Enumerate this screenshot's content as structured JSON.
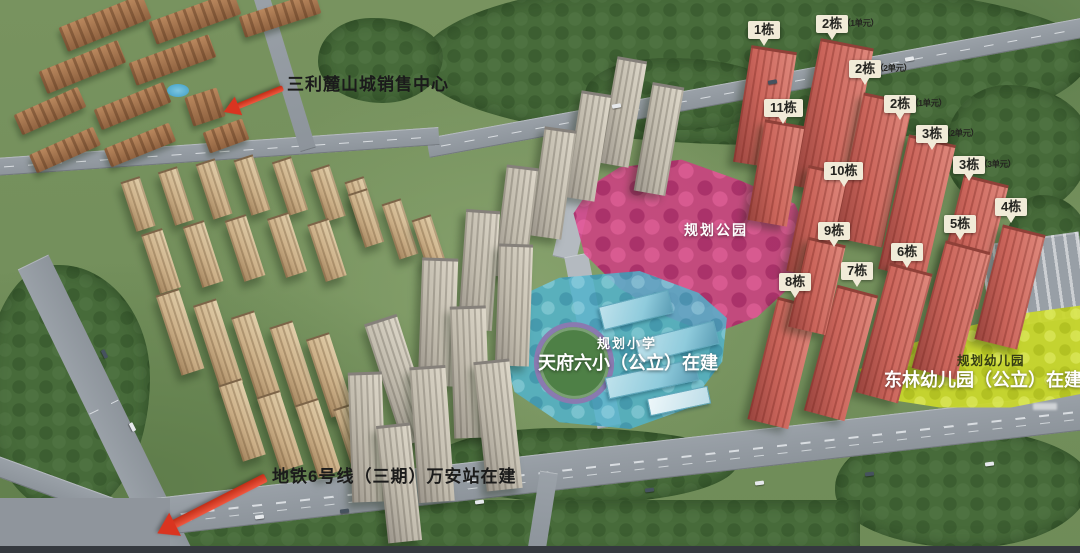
{
  "map": {
    "annotations": {
      "sales_center": "三利麓山城销售中心",
      "metro_line": "地铁6号线（三期）万安站在建",
      "park": "规划公园",
      "school_tag": "规划小学",
      "school_name": "天府六小（公立）在建",
      "kindergarten_tag": "规划幼儿园",
      "kindergarten_name": "东林幼儿园（公立）在建"
    },
    "building_labels": [
      {
        "main": "1栋",
        "sub": "",
        "x": 748,
        "y": 21
      },
      {
        "main": "2栋",
        "sub": "（1单元）",
        "x": 816,
        "y": 15
      },
      {
        "main": "2栋",
        "sub": "（2单元）",
        "x": 849,
        "y": 60
      },
      {
        "main": "2栋",
        "sub": "（1单元）",
        "x": 884,
        "y": 95
      },
      {
        "main": "3栋",
        "sub": "（2单元）",
        "x": 916,
        "y": 125
      },
      {
        "main": "3栋",
        "sub": "（3单元）",
        "x": 953,
        "y": 156
      },
      {
        "main": "4栋",
        "sub": "",
        "x": 995,
        "y": 198
      },
      {
        "main": "5栋",
        "sub": "",
        "x": 944,
        "y": 215
      },
      {
        "main": "6栋",
        "sub": "",
        "x": 891,
        "y": 243
      },
      {
        "main": "7栋",
        "sub": "",
        "x": 841,
        "y": 262
      },
      {
        "main": "8栋",
        "sub": "",
        "x": 779,
        "y": 273
      },
      {
        "main": "9栋",
        "sub": "",
        "x": 818,
        "y": 222
      },
      {
        "main": "10栋",
        "sub": "",
        "x": 824,
        "y": 162
      },
      {
        "main": "11栋",
        "sub": "",
        "x": 764,
        "y": 99
      }
    ],
    "colors": {
      "callout_bg": "#f1ebd8",
      "callout_text": "#242420",
      "arrow_red": "#da3420",
      "park_pink": "#de3e8a",
      "school_blue": "#55bcd6",
      "kindergarten_yellow": "#cddb2e",
      "red_tower": "#cb655b",
      "road_gray": "#9aa1a8"
    }
  }
}
